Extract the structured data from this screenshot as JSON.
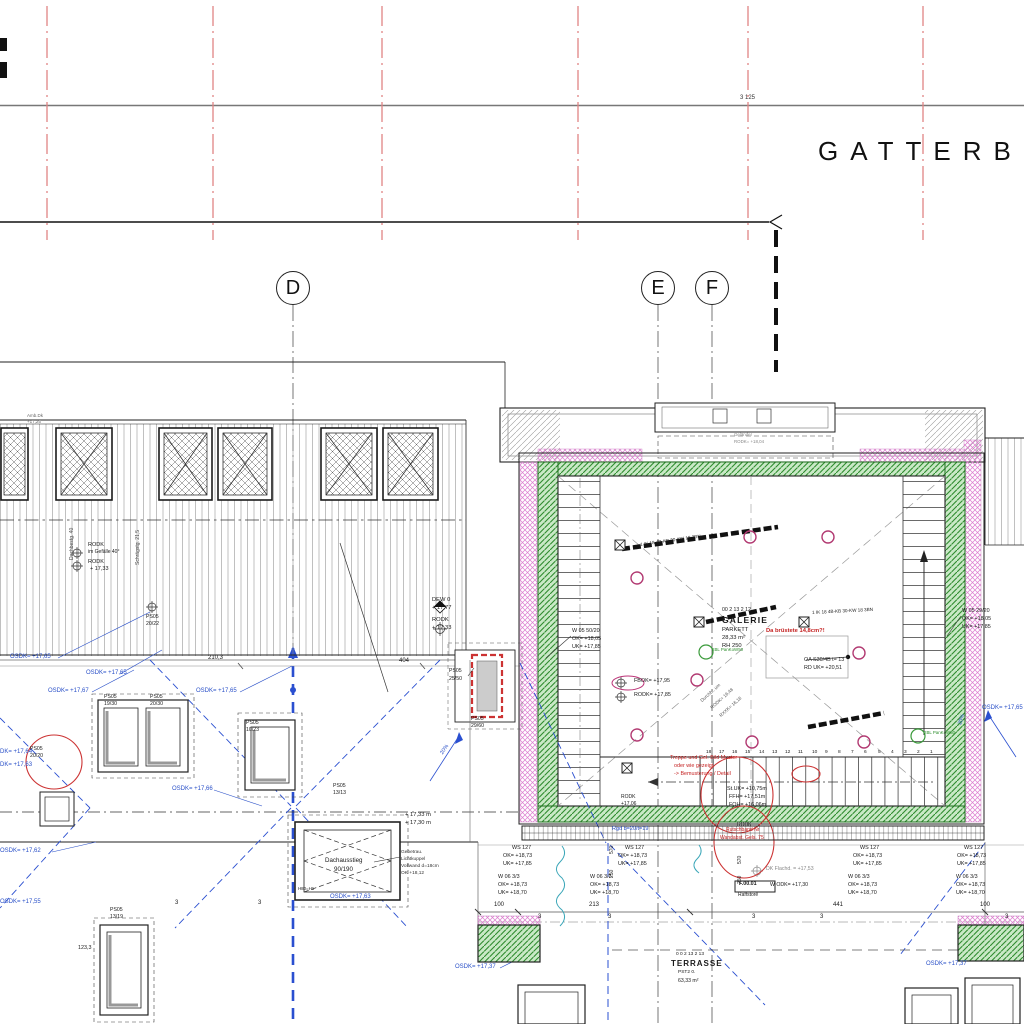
{
  "drawing": {
    "street_name": "GATTERBU",
    "type_hint": "roof storey plan"
  },
  "colors": {
    "line_black": "#1a1a1a",
    "grid_red": "#e08484",
    "accent_blue": "#2a50c8",
    "wall_green": "#2e8b2e",
    "insulation_pink": "#dd7fd0",
    "annotation_red": "#c42222",
    "downlight_magenta": "#b23a72",
    "cyan_line": "#3aa6b8"
  },
  "grid_bubbles": [
    {
      "t": "D",
      "x": 293,
      "y": 288
    },
    {
      "t": "E",
      "x": 658,
      "y": 288
    },
    {
      "t": "F",
      "x": 712,
      "y": 288
    }
  ],
  "annotations": [
    {
      "n": "street-name",
      "t": "GATTERBU",
      "x": 818,
      "y": 138,
      "s": 26,
      "ls": 12,
      "c": "#111"
    },
    {
      "n": "dim-top",
      "t": "3 125",
      "x": 740,
      "y": 95,
      "s": 6,
      "c": "#333"
    },
    {
      "n": "roof-note",
      "t": "Amb.Dk",
      "x": 27,
      "y": 414,
      "s": 4.5,
      "c": "#666"
    },
    {
      "n": "roof-note",
      "t": "+17,25",
      "x": 27,
      "y": 420,
      "s": 4.5,
      "c": "#666"
    },
    {
      "n": "rodk-label",
      "t": "RODK",
      "x": 88,
      "y": 543,
      "s": 5.5
    },
    {
      "n": "rodk-label",
      "t": "im Gefälle 40°",
      "x": 88,
      "y": 550,
      "s": 5
    },
    {
      "n": "rodk-label",
      "t": "RODK",
      "x": 88,
      "y": 560,
      "s": 5.5
    },
    {
      "n": "rodk-label",
      "t": "+ 17,33",
      "x": 90,
      "y": 567,
      "s": 5.5
    },
    {
      "n": "rafter-note",
      "t": "Dachbestg. 40",
      "x": 70,
      "y": 560,
      "s": 5,
      "r": -90,
      "c": "#444"
    },
    {
      "n": "rafter-note",
      "t": "Schrägstg. 21,5",
      "x": 136,
      "y": 565,
      "s": 5,
      "r": -90,
      "c": "#444"
    },
    {
      "n": "ps-label",
      "t": "PS05",
      "x": 146,
      "y": 615,
      "s": 5.2
    },
    {
      "n": "ps-label",
      "t": "20/22",
      "x": 146,
      "y": 622,
      "s": 5.2
    },
    {
      "n": "osdk-label",
      "t": "OSDK= +17,65",
      "x": 10,
      "y": 654,
      "s": 6,
      "c": "#2a50c8"
    },
    {
      "n": "osdk-label",
      "t": "OSDK= +17,65",
      "x": 86,
      "y": 670,
      "s": 6,
      "c": "#2a50c8"
    },
    {
      "n": "osdk-label",
      "t": "OSDK= +17,67",
      "x": 48,
      "y": 688,
      "s": 6,
      "c": "#2a50c8"
    },
    {
      "n": "osdk-label",
      "t": "OSDK= +17,65",
      "x": 196,
      "y": 688,
      "s": 6,
      "c": "#2a50c8"
    },
    {
      "n": "osdk-label",
      "t": "DK= +17,64",
      "x": 0,
      "y": 749,
      "s": 6,
      "c": "#2a50c8"
    },
    {
      "n": "osdk-label",
      "t": "DK= +17,63",
      "x": 0,
      "y": 762,
      "s": 6,
      "c": "#2a50c8"
    },
    {
      "n": "osdk-label",
      "t": "OSDK= +17,66",
      "x": 172,
      "y": 786,
      "s": 6,
      "c": "#2a50c8"
    },
    {
      "n": "osdk-label",
      "t": "OSDK= +17,62",
      "x": 0,
      "y": 848,
      "s": 6,
      "c": "#2a50c8"
    },
    {
      "n": "osdk-label",
      "t": "OSDK= +17,55",
      "x": 0,
      "y": 899,
      "s": 6,
      "c": "#2a50c8"
    },
    {
      "n": "osdk-label",
      "t": "OSDK= +17,37",
      "x": 455,
      "y": 964,
      "s": 6,
      "c": "#2a50c8"
    },
    {
      "n": "osdk-label",
      "t": "OSDK= +17,37",
      "x": 926,
      "y": 961,
      "s": 6,
      "c": "#2a50c8"
    },
    {
      "n": "osdk-label",
      "t": "OSDK= +17,65",
      "x": 982,
      "y": 705,
      "s": 6,
      "c": "#2a50c8"
    },
    {
      "n": "osdk-label",
      "t": "OSDK= +17,63",
      "x": 330,
      "y": 894,
      "s": 6,
      "c": "#2a50c8"
    },
    {
      "n": "railing-note",
      "t": "Rgd b=20/t=19",
      "x": 612,
      "y": 827,
      "s": 5.5,
      "c": "#2a50c8"
    },
    {
      "n": "ps-label",
      "t": "PS05",
      "x": 104,
      "y": 695,
      "s": 5.2
    },
    {
      "n": "ps-label",
      "t": "19/30",
      "x": 104,
      "y": 702,
      "s": 5.2
    },
    {
      "n": "ps-label",
      "t": "PS05",
      "x": 150,
      "y": 695,
      "s": 5.2
    },
    {
      "n": "ps-label",
      "t": "20/30",
      "x": 150,
      "y": 702,
      "s": 5.2
    },
    {
      "n": "ps-label",
      "t": "PS05",
      "x": 246,
      "y": 721,
      "s": 5.2
    },
    {
      "n": "ps-label",
      "t": "10/23",
      "x": 246,
      "y": 728,
      "s": 5.2
    },
    {
      "n": "ps-label",
      "t": "PS05",
      "x": 333,
      "y": 784,
      "s": 5.2
    },
    {
      "n": "ps-label",
      "t": "13/13",
      "x": 333,
      "y": 791,
      "s": 5.2
    },
    {
      "n": "ps-label",
      "t": "PS05",
      "x": 110,
      "y": 908,
      "s": 5.2
    },
    {
      "n": "ps-label",
      "t": "13/19",
      "x": 110,
      "y": 915,
      "s": 5.2
    },
    {
      "n": "ps-label",
      "t": "PS05",
      "x": 30,
      "y": 747,
      "s": 5.2
    },
    {
      "n": "ps-label",
      "t": "20/20",
      "x": 30,
      "y": 754,
      "s": 5.2
    },
    {
      "n": "ps-label",
      "t": "PS05",
      "x": 449,
      "y": 669,
      "s": 5.2
    },
    {
      "n": "ps-label",
      "t": "25/50",
      "x": 449,
      "y": 677,
      "s": 5.2
    },
    {
      "n": "ps-label",
      "t": "PS05",
      "x": 471,
      "y": 717,
      "s": 5.2
    },
    {
      "n": "ps-label",
      "t": "29/60",
      "x": 471,
      "y": 724,
      "s": 5.2
    },
    {
      "n": "dew-label",
      "t": "DEW 0",
      "x": 432,
      "y": 598,
      "s": 5.8
    },
    {
      "n": "dew-label",
      "t": "+ 17,77",
      "x": 432,
      "y": 606,
      "s": 5.8
    },
    {
      "n": "rodk-label",
      "t": "RODK",
      "x": 432,
      "y": 618,
      "s": 5.8
    },
    {
      "n": "rodk-label",
      "t": "+ 17,33",
      "x": 432,
      "y": 626,
      "s": 5.8
    },
    {
      "n": "dim-label",
      "t": "210,3",
      "x": 208,
      "y": 655,
      "s": 6
    },
    {
      "n": "dim-label",
      "t": "404",
      "x": 399,
      "y": 658,
      "s": 6
    },
    {
      "n": "room-number",
      "t": "00 2 13 2 12",
      "x": 722,
      "y": 608,
      "s": 5.2
    },
    {
      "n": "room-name",
      "t": "GALERIE",
      "x": 722,
      "y": 616,
      "s": 8.5,
      "b": true,
      "ls": 1.2
    },
    {
      "n": "room-finish",
      "t": "PARKETT",
      "x": 722,
      "y": 628,
      "s": 5.8
    },
    {
      "n": "room-area",
      "t": "28,33 m²",
      "x": 722,
      "y": 636,
      "s": 5.8
    },
    {
      "n": "room-height",
      "t": "RH 250",
      "x": 722,
      "y": 644,
      "s": 5.8
    },
    {
      "n": "redline-note",
      "t": "Da brüstete 14,8cm?!",
      "x": 766,
      "y": 629,
      "s": 5.8,
      "b": true,
      "c": "#c42222"
    },
    {
      "n": "beam-note",
      "t": "OA S30/4B t= 13",
      "x": 804,
      "y": 658,
      "s": 5.4
    },
    {
      "n": "beam-note",
      "t": "RD UK= +20,51",
      "x": 804,
      "y": 666,
      "s": 5.4
    },
    {
      "n": "beam-label",
      "t": "1 IK 18 4B-KB 30-KW 18 3BN",
      "x": 640,
      "y": 543,
      "s": 4.6,
      "r": -8
    },
    {
      "n": "beam-label",
      "t": "1 IK 18 4B-KB 30-KW 18 3BN",
      "x": 812,
      "y": 611,
      "s": 4.6,
      "r": -3
    },
    {
      "n": "diag-note",
      "t": "Durchbr. um",
      "x": 700,
      "y": 700,
      "s": 4.6,
      "r": -42,
      "c": "#555"
    },
    {
      "n": "diag-note",
      "t": "RODK= 16,48",
      "x": 710,
      "y": 707,
      "s": 4.6,
      "r": -42,
      "c": "#555"
    },
    {
      "n": "diag-note",
      "t": "RXXK= 16,16",
      "x": 719,
      "y": 715,
      "s": 4.6,
      "r": -42,
      "c": "#555"
    },
    {
      "n": "green-note",
      "t": "2BL PanKoW50",
      "x": 712,
      "y": 648,
      "s": 4.4,
      "c": "#2f8f2f"
    },
    {
      "n": "green-note",
      "t": "2BL PanKoW50",
      "x": 924,
      "y": 731,
      "s": 4.4,
      "c": "#2f8f2f"
    },
    {
      "n": "window-label",
      "t": "W 05 50/20",
      "x": 572,
      "y": 629,
      "s": 5.4
    },
    {
      "n": "window-label",
      "t": "OK= +18,05",
      "x": 572,
      "y": 637,
      "s": 5.4
    },
    {
      "n": "window-label",
      "t": "UK= +17,85",
      "x": 572,
      "y": 645,
      "s": 5.4
    },
    {
      "n": "window-label",
      "t": "W 05 29/20",
      "x": 962,
      "y": 609,
      "s": 5.4
    },
    {
      "n": "window-label",
      "t": "OK= +18,05",
      "x": 962,
      "y": 617,
      "s": 5.4
    },
    {
      "n": "window-label",
      "t": "UK= +17,85",
      "x": 962,
      "y": 625,
      "s": 5.4
    },
    {
      "n": "level-label",
      "t": "FBOK= +17,95",
      "x": 634,
      "y": 679,
      "s": 5.4
    },
    {
      "n": "level-label",
      "t": "RODK= +17,85",
      "x": 634,
      "y": 693,
      "s": 5.4
    },
    {
      "n": "railing-gray",
      "t": "Geländer",
      "x": 734,
      "y": 433,
      "s": 4.4,
      "c": "#888"
    },
    {
      "n": "railing-gray",
      "t": "RODK= +18,04",
      "x": 734,
      "y": 440,
      "s": 4.4,
      "c": "#888"
    },
    {
      "n": "red-note",
      "t": "Treppe und Gel. Bild Muster",
      "x": 670,
      "y": 756,
      "s": 5.4,
      "c": "#c42222"
    },
    {
      "n": "red-note",
      "t": "oder wie gezeigt",
      "x": 674,
      "y": 764,
      "s": 5.4,
      "c": "#c42222"
    },
    {
      "n": "red-note",
      "t": "-> Bemusterung / Detail",
      "x": 674,
      "y": 772,
      "s": 5.4,
      "c": "#c42222"
    },
    {
      "n": "stair-level",
      "t": "St.UK= +10,75m",
      "x": 727,
      "y": 787,
      "s": 5.4
    },
    {
      "n": "stair-level",
      "t": "FFH= +17,51m",
      "x": 729,
      "y": 795,
      "s": 5.4
    },
    {
      "n": "stair-level",
      "t": "FOH= +16,06m",
      "x": 729,
      "y": 803,
      "s": 5.4
    },
    {
      "n": "rodk-label",
      "t": "RODK",
      "x": 621,
      "y": 795,
      "s": 5
    },
    {
      "n": "rodk-label",
      "t": "+17,06",
      "x": 621,
      "y": 802,
      "s": 5
    },
    {
      "n": "rodk-label",
      "t": "RODK",
      "x": 737,
      "y": 823,
      "s": 5
    },
    {
      "n": "red-note",
      "t": "Rutschband Nr",
      "x": 726,
      "y": 828,
      "s": 5,
      "c": "#c42222"
    },
    {
      "n": "red-note",
      "t": "Wandabst. Gels. 75",
      "x": 720,
      "y": 836,
      "s": 5,
      "c": "#c42222"
    },
    {
      "n": "level-label",
      "t": "+ 17,33 m",
      "x": 405,
      "y": 813,
      "s": 5.8
    },
    {
      "n": "level-label",
      "t": "+ 17,30 m",
      "x": 405,
      "y": 821,
      "s": 5.8
    },
    {
      "n": "hatch-label",
      "t": "Dachausstieg",
      "x": 325,
      "y": 858,
      "s": 6.2
    },
    {
      "n": "hatch-label",
      "t": "90/190",
      "x": 334,
      "y": 867,
      "s": 6.2
    },
    {
      "n": "hatch-label",
      "t": "H80=H1",
      "x": 298,
      "y": 887,
      "s": 4.4
    },
    {
      "n": "kuppel-note",
      "t": "Gebetrau.",
      "x": 401,
      "y": 851,
      "s": 4.8,
      "c": "#333"
    },
    {
      "n": "kuppel-note",
      "t": "Lichtkuppel",
      "x": 401,
      "y": 858,
      "s": 4.8,
      "c": "#333"
    },
    {
      "n": "kuppel-note",
      "t": "Vollwand d=18cm",
      "x": 401,
      "y": 865,
      "s": 4.8,
      "c": "#333"
    },
    {
      "n": "kuppel-note",
      "t": "OK +18,12",
      "x": 401,
      "y": 872,
      "s": 4.8,
      "c": "#333"
    },
    {
      "n": "window-label",
      "t": "WS 127",
      "x": 512,
      "y": 846,
      "s": 5.4
    },
    {
      "n": "window-label",
      "t": "OK= +18,73",
      "x": 503,
      "y": 854,
      "s": 5.4
    },
    {
      "n": "window-label",
      "t": "UK= +17,85",
      "x": 503,
      "y": 862,
      "s": 5.4
    },
    {
      "n": "window-label",
      "t": "WS 127",
      "x": 625,
      "y": 846,
      "s": 5.4
    },
    {
      "n": "window-label",
      "t": "OK= +18,73",
      "x": 618,
      "y": 854,
      "s": 5.4
    },
    {
      "n": "window-label",
      "t": "UK= +17,85",
      "x": 618,
      "y": 862,
      "s": 5.4
    },
    {
      "n": "window-label",
      "t": "WS 127",
      "x": 860,
      "y": 846,
      "s": 5.4
    },
    {
      "n": "window-label",
      "t": "OK= +18,73",
      "x": 853,
      "y": 854,
      "s": 5.4
    },
    {
      "n": "window-label",
      "t": "UK= +17,85",
      "x": 853,
      "y": 862,
      "s": 5.4
    },
    {
      "n": "window-label",
      "t": "WS 127",
      "x": 964,
      "y": 846,
      "s": 5.4
    },
    {
      "n": "window-label",
      "t": "OK= +18,73",
      "x": 957,
      "y": 854,
      "s": 5.4
    },
    {
      "n": "window-label",
      "t": "UK= +17,85",
      "x": 957,
      "y": 862,
      "s": 5.4
    },
    {
      "n": "window-label",
      "t": "W 06 3/3",
      "x": 498,
      "y": 875,
      "s": 5.4
    },
    {
      "n": "window-label",
      "t": "OK= +18,73",
      "x": 498,
      "y": 883,
      "s": 5.4
    },
    {
      "n": "window-label",
      "t": "UK= +18,70",
      "x": 498,
      "y": 891,
      "s": 5.4
    },
    {
      "n": "window-label",
      "t": "W 06 3/3",
      "x": 590,
      "y": 875,
      "s": 5.4
    },
    {
      "n": "window-label",
      "t": "OK= +18,73",
      "x": 590,
      "y": 883,
      "s": 5.4
    },
    {
      "n": "window-label",
      "t": "UK= +18,70",
      "x": 590,
      "y": 891,
      "s": 5.4
    },
    {
      "n": "window-label",
      "t": "W 06 3/3",
      "x": 848,
      "y": 875,
      "s": 5.4
    },
    {
      "n": "window-label",
      "t": "OK= +18,73",
      "x": 848,
      "y": 883,
      "s": 5.4
    },
    {
      "n": "window-label",
      "t": "UK= +18,70",
      "x": 848,
      "y": 891,
      "s": 5.4
    },
    {
      "n": "window-label",
      "t": "W 06 3/3",
      "x": 956,
      "y": 875,
      "s": 5.4
    },
    {
      "n": "window-label",
      "t": "OK= +18,73",
      "x": 956,
      "y": 883,
      "s": 5.4
    },
    {
      "n": "window-label",
      "t": "UK= +18,70",
      "x": 956,
      "y": 891,
      "s": 5.4
    },
    {
      "n": "flat-roof-note",
      "t": "DK Flachd. = +17,53",
      "x": 766,
      "y": 867,
      "s": 5.2,
      "c": "#888"
    },
    {
      "n": "flat-roof-note",
      "t": "W ODK= +17,30",
      "x": 770,
      "y": 883,
      "s": 5.2
    },
    {
      "n": "door-tag",
      "t": "F.00.01",
      "x": 739,
      "y": 882,
      "s": 5.4,
      "b": true
    },
    {
      "n": "door-tag",
      "t": "Raffstore",
      "x": 738,
      "y": 893,
      "s": 5
    },
    {
      "n": "dim-label",
      "t": "100",
      "x": 494,
      "y": 902,
      "s": 6
    },
    {
      "n": "dim-label",
      "t": "213",
      "x": 589,
      "y": 902,
      "s": 6
    },
    {
      "n": "dim-label",
      "t": "441",
      "x": 833,
      "y": 902,
      "s": 6
    },
    {
      "n": "dim-label",
      "t": "100",
      "x": 980,
      "y": 902,
      "s": 6
    },
    {
      "n": "dim-tick",
      "t": "3",
      "x": 538,
      "y": 914,
      "s": 6
    },
    {
      "n": "dim-tick",
      "t": "3",
      "x": 608,
      "y": 914,
      "s": 6
    },
    {
      "n": "dim-tick",
      "t": "3",
      "x": 752,
      "y": 914,
      "s": 6
    },
    {
      "n": "dim-tick",
      "t": "3",
      "x": 820,
      "y": 914,
      "s": 6
    },
    {
      "n": "dim-tick",
      "t": "3",
      "x": 1005,
      "y": 914,
      "s": 6
    },
    {
      "n": "dim-tick",
      "t": "3",
      "x": 175,
      "y": 900,
      "s": 6
    },
    {
      "n": "dim-tick",
      "t": "3",
      "x": 258,
      "y": 900,
      "s": 6
    },
    {
      "n": "dim-rot",
      "t": "570",
      "x": 738,
      "y": 864,
      "s": 5,
      "r": -90
    },
    {
      "n": "dim-rot",
      "t": "250",
      "x": 738,
      "y": 884,
      "s": 5,
      "r": -90
    },
    {
      "n": "dim-rot",
      "t": "570",
      "x": 610,
      "y": 854,
      "s": 5,
      "r": -90
    },
    {
      "n": "dim-rot",
      "t": "250",
      "x": 610,
      "y": 878,
      "s": 5,
      "r": -90
    },
    {
      "n": "room-number",
      "t": "0 0 2 13 2 13",
      "x": 676,
      "y": 953,
      "s": 4.8
    },
    {
      "n": "room-name",
      "t": "TERRASSE",
      "x": 671,
      "y": 960,
      "s": 8,
      "b": true,
      "ls": 1
    },
    {
      "n": "room-finish",
      "t": "PST2 0.",
      "x": 678,
      "y": 971,
      "s": 4.8
    },
    {
      "n": "room-area",
      "t": "63,33 m²",
      "x": 678,
      "y": 979,
      "s": 5.2
    },
    {
      "n": "slope-label",
      "t": "20%",
      "x": 440,
      "y": 753,
      "s": 5.4,
      "r": -55,
      "c": "#2a50c8"
    },
    {
      "n": "slope-label",
      "t": "20%",
      "x": 958,
      "y": 724,
      "s": 5.4,
      "r": -70,
      "c": "#2a50c8"
    },
    {
      "n": "dim-label",
      "t": "123,3",
      "x": 78,
      "y": 946,
      "s": 5.4
    },
    {
      "n": "tread-number",
      "t": "18",
      "x": 706,
      "y": 751,
      "s": 4.8
    },
    {
      "n": "tread-number",
      "t": "17",
      "x": 719,
      "y": 751,
      "s": 4.8
    },
    {
      "n": "tread-number",
      "t": "16",
      "x": 732,
      "y": 751,
      "s": 4.8
    },
    {
      "n": "tread-number",
      "t": "15",
      "x": 745,
      "y": 751,
      "s": 4.8
    },
    {
      "n": "tread-number",
      "t": "14",
      "x": 759,
      "y": 751,
      "s": 4.8
    },
    {
      "n": "tread-number",
      "t": "13",
      "x": 772,
      "y": 751,
      "s": 4.8
    },
    {
      "n": "tread-number",
      "t": "12",
      "x": 785,
      "y": 751,
      "s": 4.8
    },
    {
      "n": "tread-number",
      "t": "11",
      "x": 798,
      "y": 751,
      "s": 4.8
    },
    {
      "n": "tread-number",
      "t": "10",
      "x": 812,
      "y": 751,
      "s": 4.8
    },
    {
      "n": "tread-number",
      "t": "9",
      "x": 825,
      "y": 751,
      "s": 4.8
    },
    {
      "n": "tread-number",
      "t": "8",
      "x": 838,
      "y": 751,
      "s": 4.8
    },
    {
      "n": "tread-number",
      "t": "7",
      "x": 851,
      "y": 751,
      "s": 4.8
    },
    {
      "n": "tread-number",
      "t": "6",
      "x": 864,
      "y": 751,
      "s": 4.8
    },
    {
      "n": "tread-number",
      "t": "5",
      "x": 878,
      "y": 751,
      "s": 4.8
    },
    {
      "n": "tread-number",
      "t": "4",
      "x": 891,
      "y": 751,
      "s": 4.8
    },
    {
      "n": "tread-number",
      "t": "3",
      "x": 904,
      "y": 751,
      "s": 4.8
    },
    {
      "n": "tread-number",
      "t": "2",
      "x": 917,
      "y": 751,
      "s": 4.8
    },
    {
      "n": "tread-number",
      "t": "1",
      "x": 930,
      "y": 751,
      "s": 4.8
    }
  ]
}
